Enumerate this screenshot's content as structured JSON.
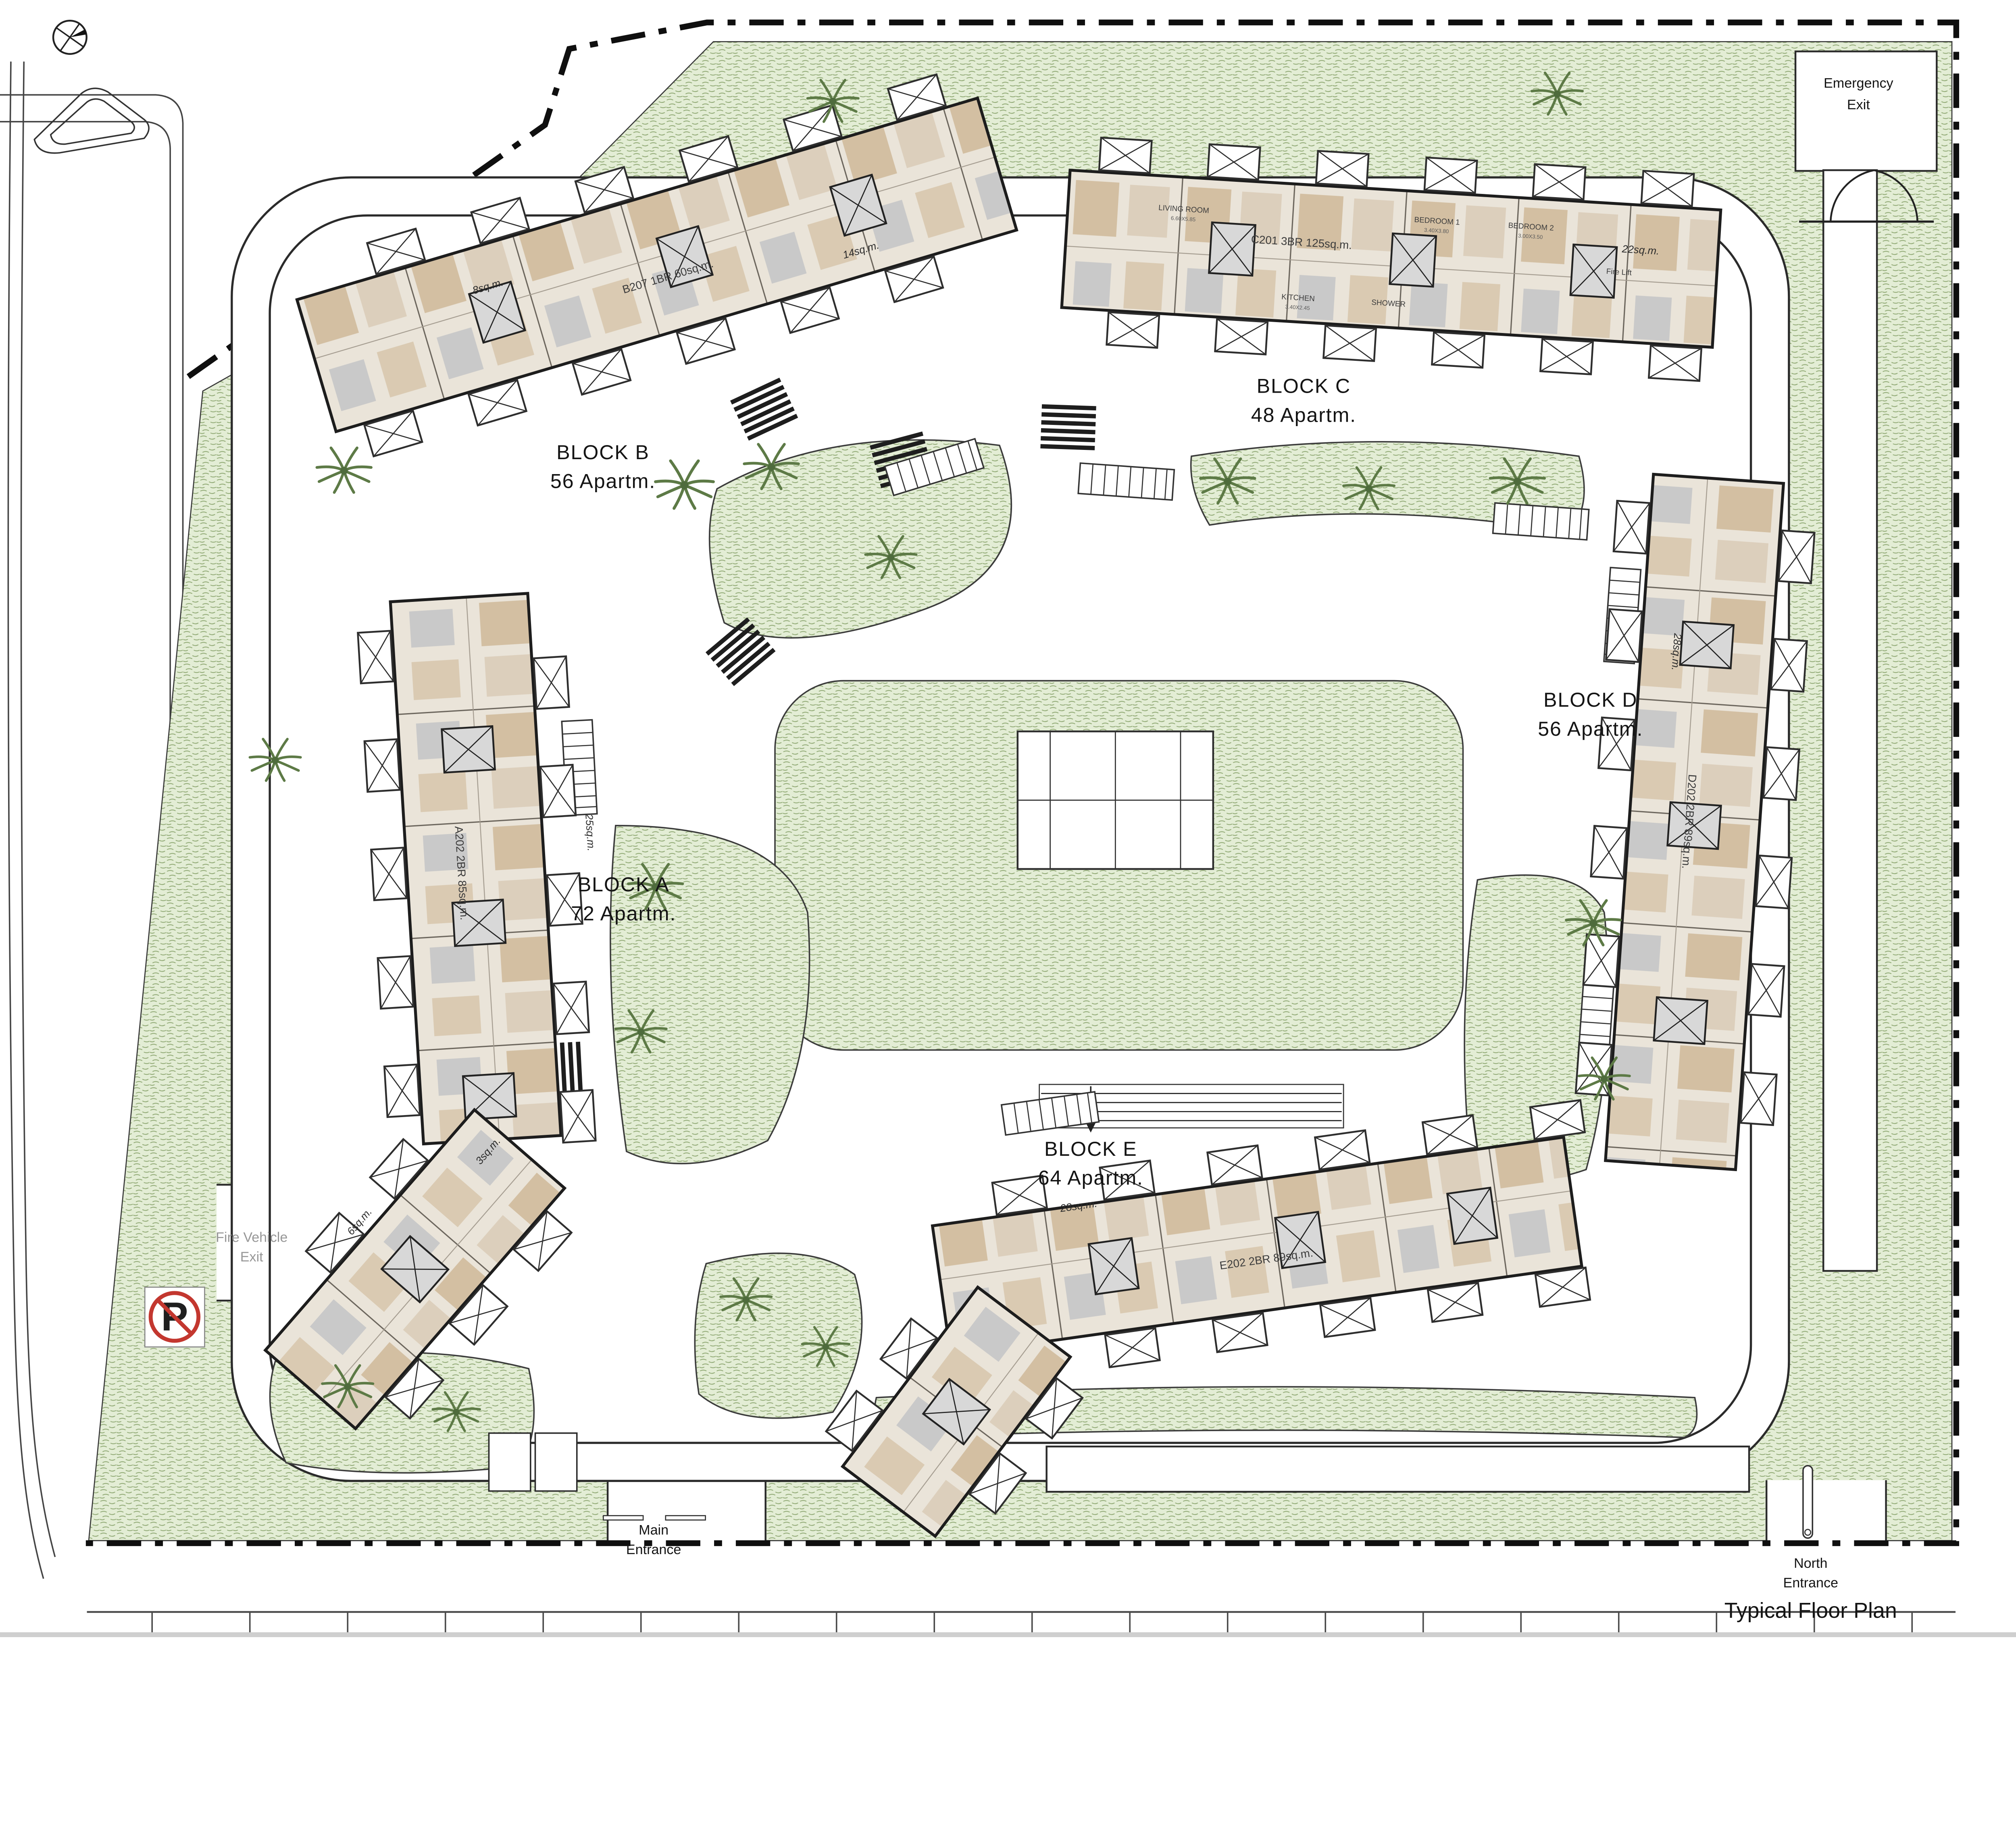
{
  "title": "Typical Floor Plan",
  "blocks": [
    {
      "name": "BLOCK A",
      "units": "72 Apartm.",
      "sample_unit": "A202  2BR  85sq.m."
    },
    {
      "name": "BLOCK B",
      "units": "56 Apartm.",
      "sample_unit": "B207  1BR  60sq.m."
    },
    {
      "name": "BLOCK C",
      "units": "48 Apartm.",
      "sample_unit": "C201  3BR  125sq.m."
    },
    {
      "name": "BLOCK D",
      "units": "56 Apartm.",
      "sample_unit": "D202  2BR  89sq.m."
    },
    {
      "name": "BLOCK E",
      "units": "64 Apartm.",
      "sample_unit": "E202  2BR  89sq.m."
    }
  ],
  "entrances": {
    "emergency": {
      "line1": "Emergency",
      "line2": "Exit"
    },
    "main": {
      "line1": "Main",
      "line2": "Entrance"
    },
    "north": {
      "line1": "North",
      "line2": "Entrance"
    },
    "fire": {
      "line1": "Fire Vehicle",
      "line2": "Exit"
    }
  },
  "signs": {
    "no_parking": "P"
  },
  "areas": [
    "8sq.m.",
    "14sq.m.",
    "22sq.m.",
    "28sq.m.",
    "25sq.m.",
    "28sq.m.",
    "6sq.m.",
    "3sq.m."
  ],
  "rooms": [
    {
      "name": "LIVING ROOM",
      "dim": "6.60X5.85"
    },
    {
      "name": "BEDROOM 1",
      "dim": "3.40X3.80"
    },
    {
      "name": "BEDROOM 2",
      "dim": "3.00X3.50"
    },
    {
      "name": "KITCHEN",
      "dim": "3.40X2.45"
    },
    {
      "name": "SHOWER",
      "dim": ""
    },
    {
      "name": "Fire Lift",
      "dim": ""
    }
  ],
  "unit_codes_visible": [
    "A201",
    "A202",
    "B207",
    "C201",
    "C202",
    "D202",
    "E202",
    "E207"
  ],
  "room_dims_visible": [
    "3.40X3.80",
    "3.00X3.50",
    "3.00X4.60",
    "4.00X4.60",
    "6.60X5.85",
    "6.00X5.85",
    "8.00X5.50",
    "3.40X2.45",
    "3.50X3.40",
    "3.60X3.75",
    "3.30X3.20",
    "3.15X4.00"
  ],
  "colors": {
    "landscape": "#e3edd5",
    "landscape_stroke": "#8fa873",
    "building": "#eae4d9",
    "wood": "#d3bfa2",
    "wall": "#1d1d1d",
    "road_line": "#2b2b2b",
    "no_parking_red": "#c3372f"
  }
}
